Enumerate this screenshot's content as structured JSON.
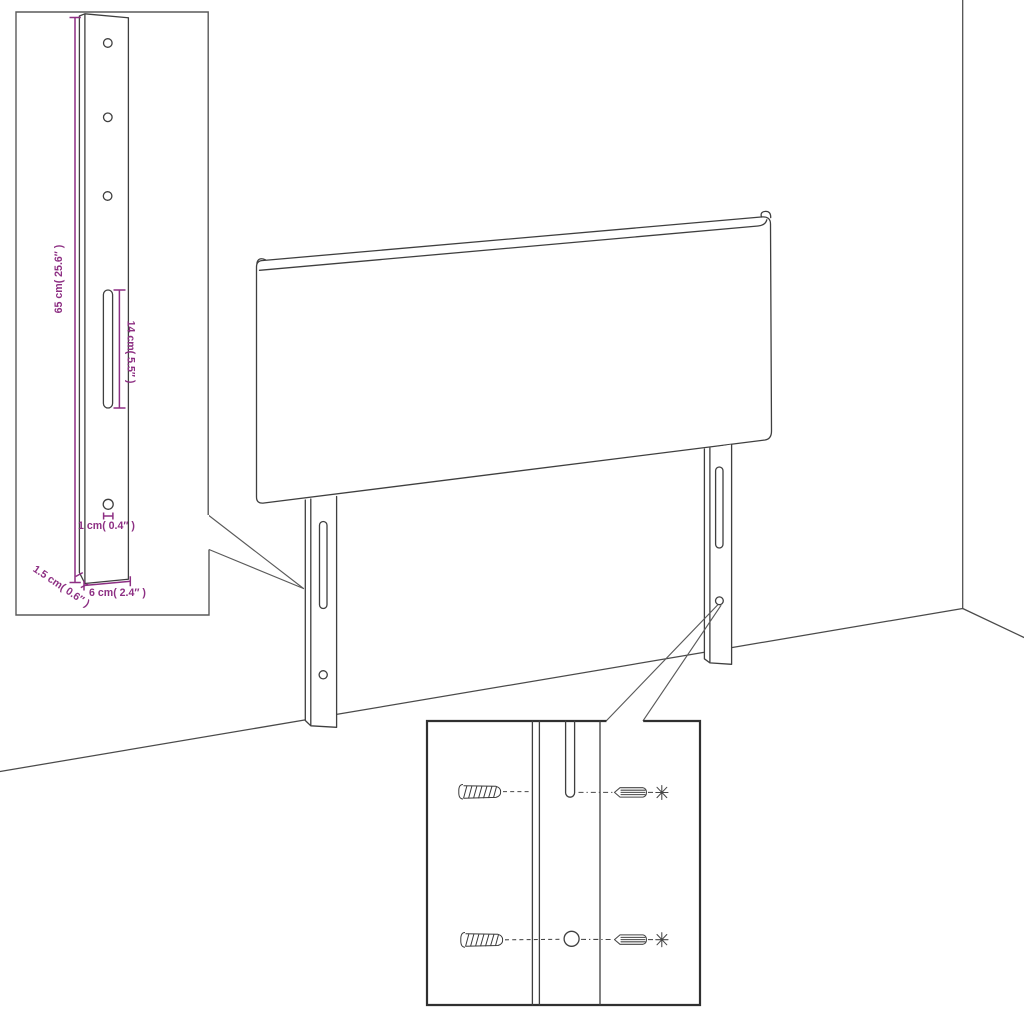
{
  "diagram": {
    "title": "headboard-assembly-dimension-diagram",
    "colors": {
      "background": "#ffffff",
      "line": "#3f3f3f",
      "dimension": "#8d2f83"
    },
    "dimensions": {
      "height_label": "65 cm( 25.6″ )",
      "slot_label": "14 cm( 5.5″ )",
      "hole_label": "1 cm( 0.4″ )",
      "thickness_label": "1.5 cm( 0.6″ )",
      "width_label": "6 cm( 2.4″ )"
    },
    "parts": {
      "panel": "headboard-panel",
      "left_leg": "headboard-leg-left",
      "right_leg": "headboard-leg-right",
      "leg_detail_inset": "leg-dimension-inset",
      "mounting_detail_inset": "wall-mounting-inset",
      "fasteners": [
        "wall-plug",
        "screw"
      ]
    }
  }
}
